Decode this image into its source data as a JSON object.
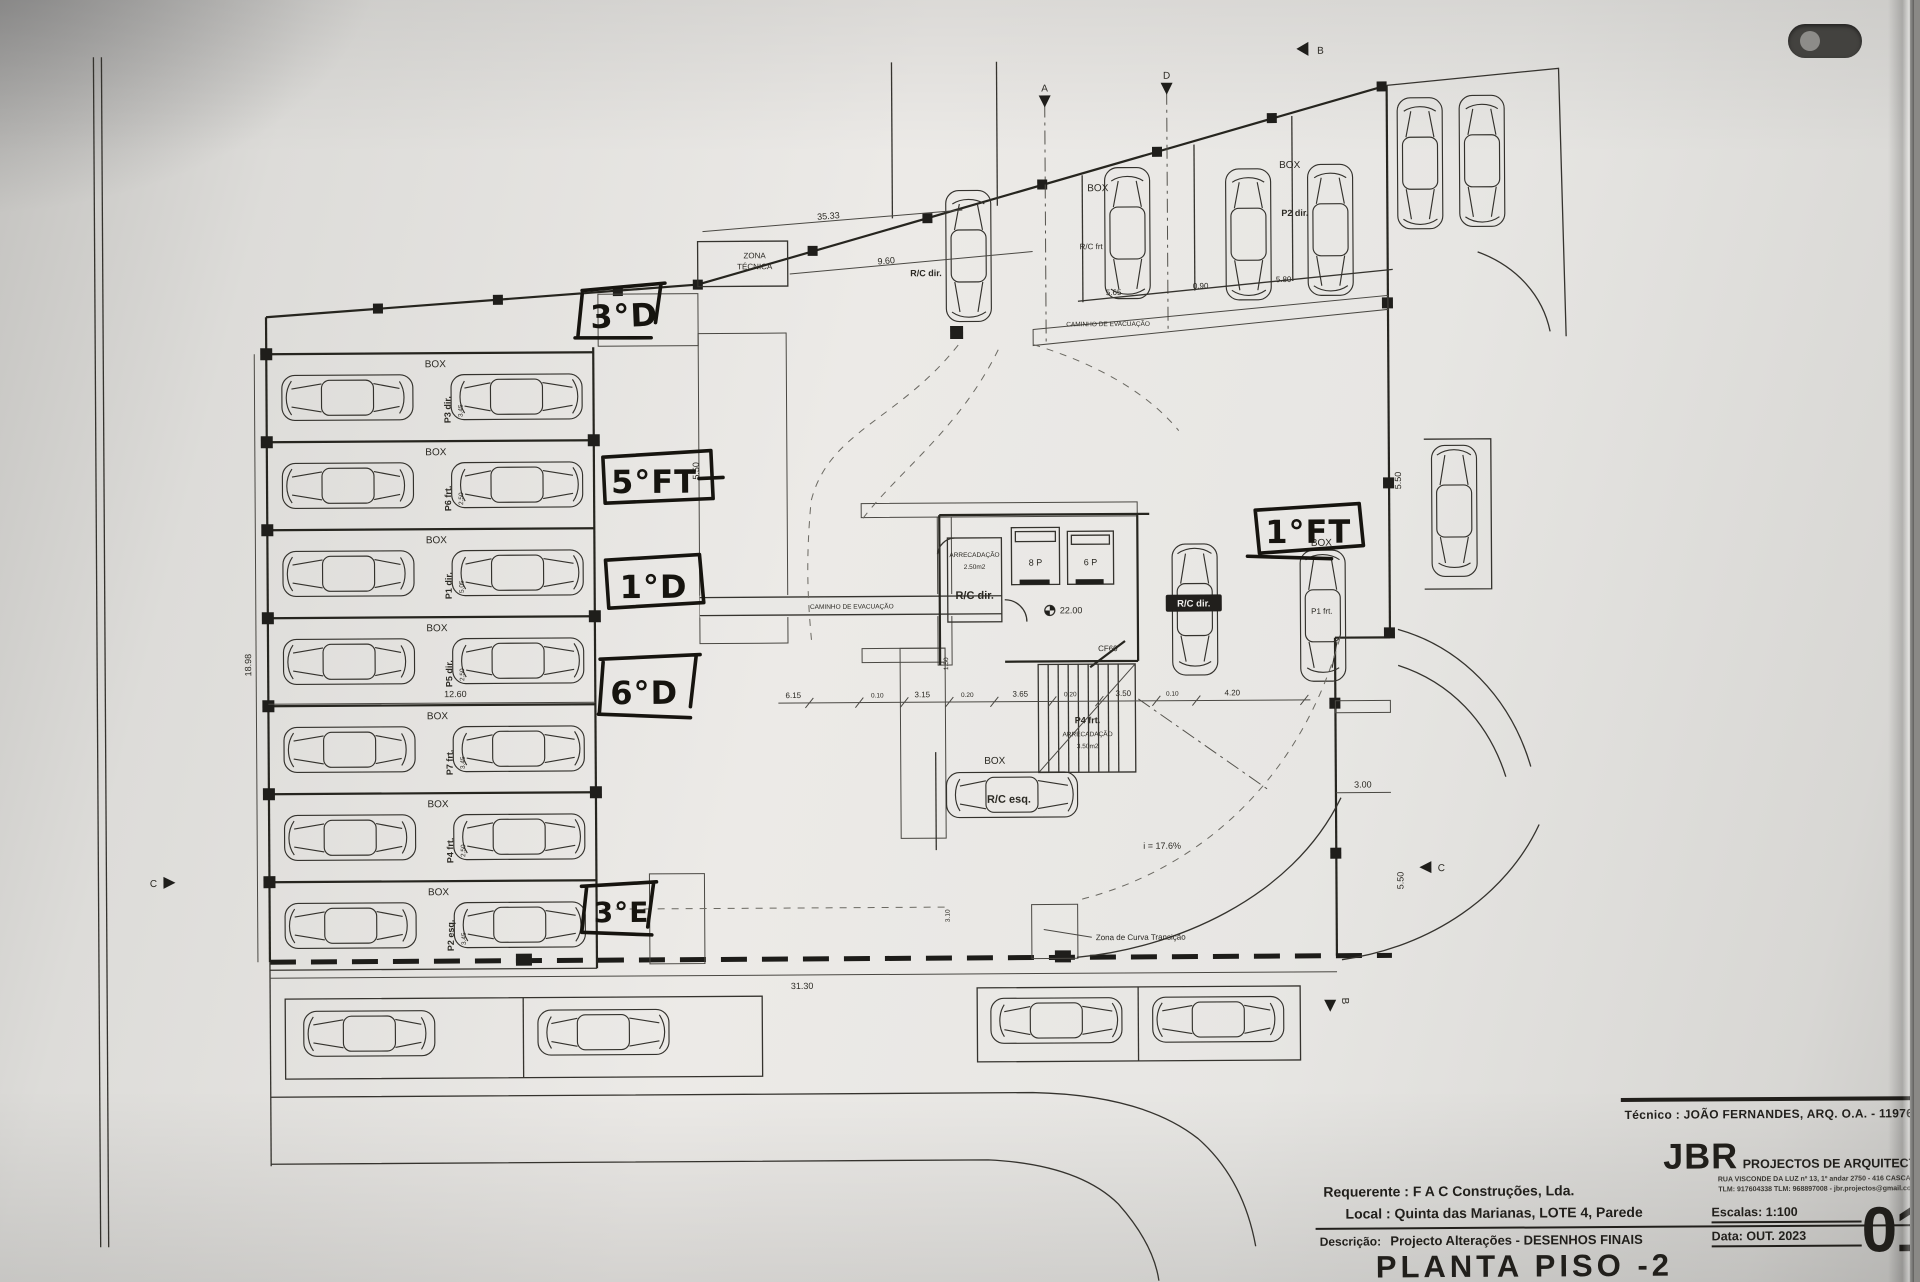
{
  "plan": {
    "handwritten": [
      "3°D",
      "5°FT",
      "1°D",
      "6°D",
      "3°E",
      "1°FT"
    ],
    "labels": {
      "box": "BOX",
      "zona_tecnica_line1": "ZONA",
      "zona_tecnica_line2": "TÉCNICA",
      "caminho_evacuacao": "CAMINHO DE EVACUAÇÃO",
      "rc_frt": "R/C frt",
      "rc_dir": "R/C dir.",
      "rc_esq": "R/C esq.",
      "p2_dir": "P2 dir.",
      "p1_frt": "P1 frt.",
      "p4_frt": "P4 frt.",
      "arrecadacao": "ARRECADAÇÃO",
      "arrecadacao_area_1": "2.50m2",
      "arrecadacao_area_2": "3.50m2",
      "elevator_1": "8 P",
      "elevator_2": "6 P",
      "door_cf60": "CF60",
      "level": "22.00",
      "ramp_slope": "i = 17.6%",
      "curve_zone": "Zona de Curva Transição"
    },
    "stalls": [
      {
        "label": "P3 dir.",
        "dim": "3.45"
      },
      {
        "label": "P6 frt.",
        "dim": "2.50"
      },
      {
        "label": "P1 dir.",
        "dim": "5.05"
      },
      {
        "label": "P5 dir.",
        "dim": "2.50"
      },
      {
        "label": "P7 frt.",
        "dim": "3.45"
      },
      {
        "label": "P4 frt.",
        "dim": "2.50"
      },
      {
        "label": "P2 esq.",
        "dim": "3.45"
      }
    ],
    "dimensions": {
      "top": "35.33",
      "d960": "9.60",
      "d565": "5.65",
      "d090": "0.90",
      "d580": "5.80",
      "left_height": "18.98",
      "d1260": "12.60",
      "bottom": "31.30",
      "chain": [
        "6.15",
        "0.10",
        "3.15",
        "0.20",
        "3.65",
        "0.20",
        "3.50",
        "0.10",
        "4.20"
      ],
      "d300": "3.00",
      "d550": "5.50",
      "d150": "1.50",
      "d310": "3.10"
    },
    "sections": {
      "a": "A",
      "b": "B",
      "c": "C",
      "d": "D"
    }
  },
  "titleblock": {
    "tecnico_label": "Técnico :",
    "tecnico_name": "JOÃO FERNANDES, ARQ.",
    "tecnico_reg": "O.A. - 11976",
    "company": "JBR",
    "company_sub": "PROJECTOS DE ARQUITECTURA",
    "address1": "RUA VISCONDE DA LUZ nº 13, 1º andar  2750 - 416  CASCAIS",
    "address2": "TLM: 917604338  TLM: 968897008 - jbr.projectos@gmail.com",
    "requerente_label": "Requerente :",
    "requerente_value": "F A C  Construções, Lda.",
    "local_label": "Local :",
    "local_value": "Quinta das Marianas, LOTE 4, Parede",
    "descricao_label": "Descrição:",
    "descricao_value": "Projecto Alterações - DESENHOS FINAIS",
    "title": "PLANTA PISO -2",
    "escala_label": "Escalas:",
    "escala_value": "1:100",
    "data_label": "Data:",
    "data_value": "OUT. 2023",
    "sheet_number": "01"
  }
}
